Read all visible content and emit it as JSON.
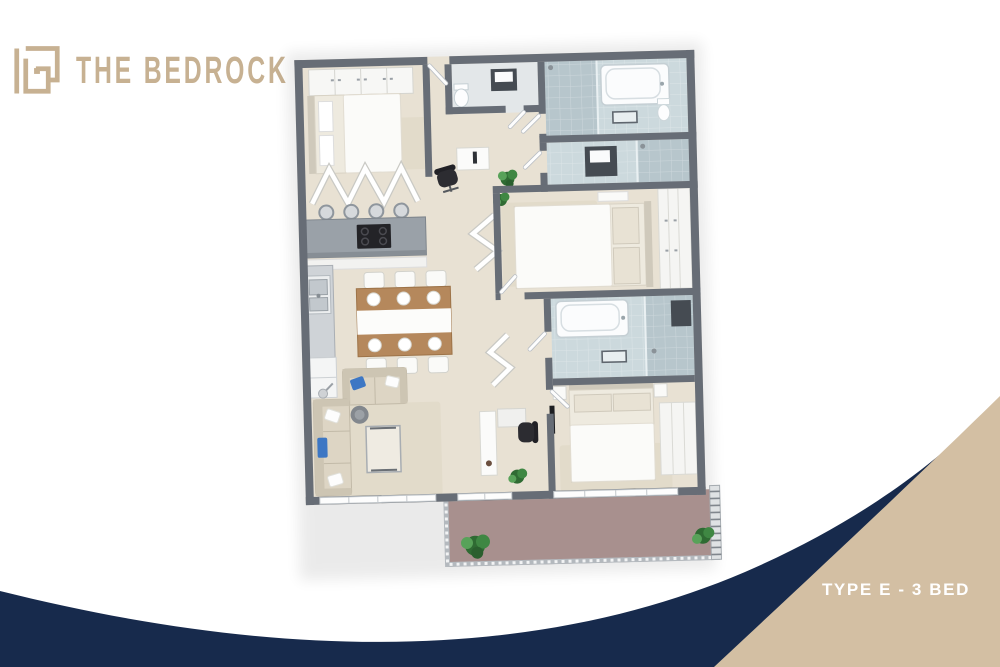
{
  "page": {
    "kind": "real-estate floor plan poster",
    "view": "3d isometric top-down render"
  },
  "header": {
    "brand": "THE BEDROCK",
    "logo_icon": "bedrock-maze-monogram"
  },
  "footer": {
    "plan_label": "TYPE E - 3 BED"
  },
  "colors": {
    "background": "#ffffff",
    "navy": "#172a4c",
    "tan": "#d3bfa3",
    "logo": "#c7b192",
    "wall": "#676d76",
    "floor": "#e8e1d3",
    "tile": "#ccd9dd",
    "tile_dark": "#b7c6cc",
    "balcony": "#a8908e",
    "rug": "#e2dbca",
    "wood": "#b5885c",
    "sofa": "#ddd5c4",
    "pillow_blue": "#3d77c4",
    "plant": "#3f8743",
    "dark": "#2c2c31",
    "counter": "#9aa1a8"
  },
  "floor_plan": {
    "unit_label": "TYPE E - 3 BED",
    "bedrooms": 3,
    "rooms": [
      "bedroom-top-left",
      "entry-hall",
      "wc",
      "main-bathroom",
      "ensuite-shower-room",
      "bedroom-middle-right",
      "wardrobe-corridor",
      "second-bathroom",
      "bedroom-bottom-right",
      "kitchen",
      "dining-area",
      "living-room",
      "study-nook",
      "hallway",
      "balcony"
    ],
    "furnishings": [
      "double-bed x3",
      "wardrobes",
      "bathtub x2",
      "walk-in-shower x3",
      "vanity x2",
      "toilet x2",
      "kitchen-island-with-cooktop",
      "bar-stools x4",
      "double-sink",
      "fridge",
      "dining-table-6-seats",
      "sofa x2",
      "glass-coffee-table",
      "round-side-table",
      "floor-lamp",
      "office-desk-and-chair x2",
      "console-table",
      "potted-plants x5",
      "area-rugs",
      "balcony-railing"
    ]
  }
}
